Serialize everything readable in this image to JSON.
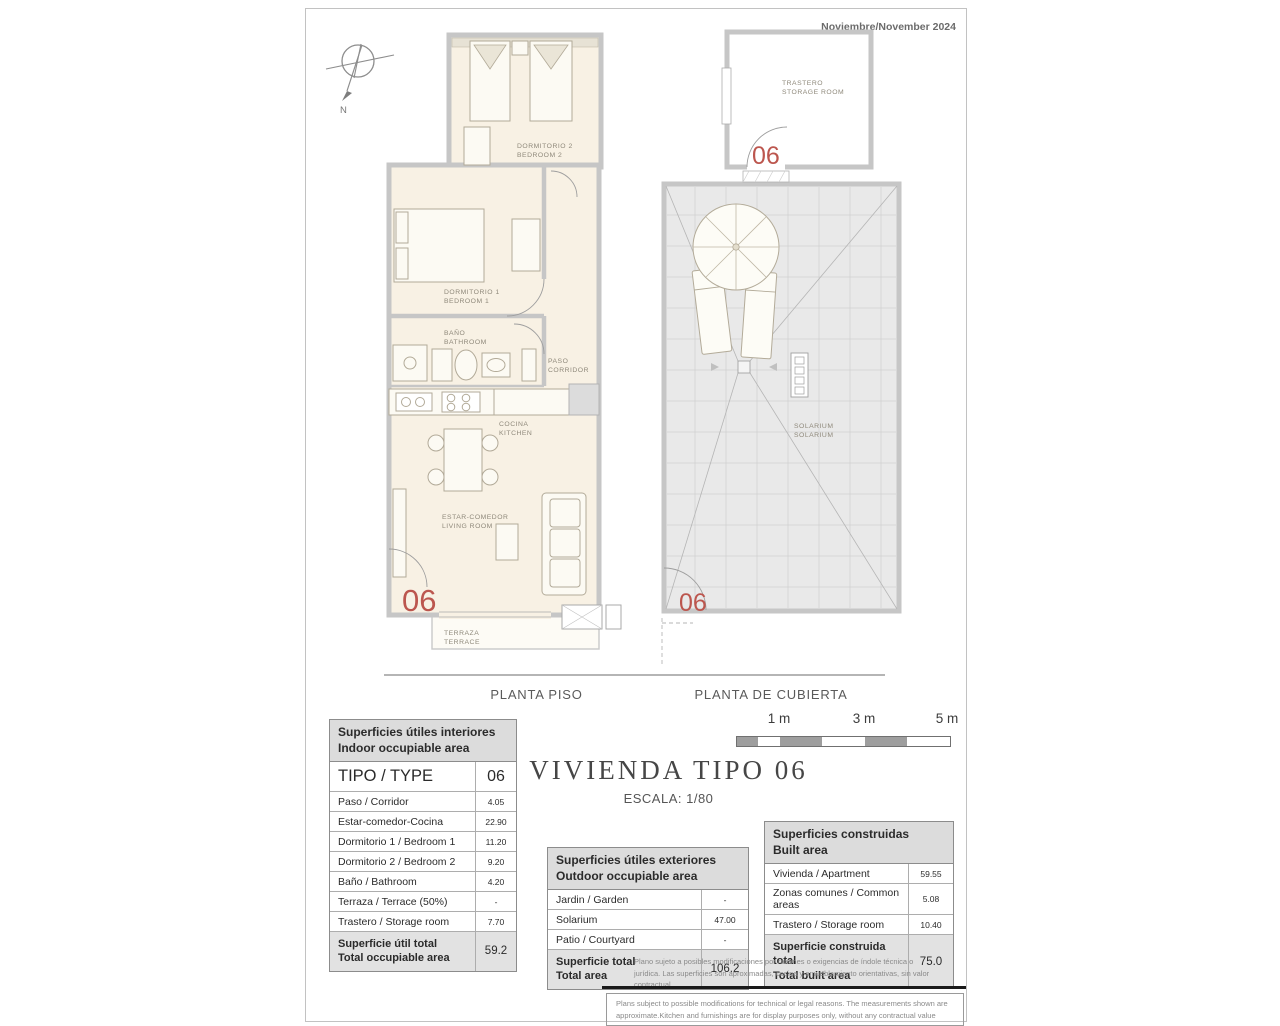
{
  "page": {
    "date": "Noviembre/November 2024",
    "title": "VIVIENDA TIPO 06",
    "scale": "ESCALA: 1/80",
    "unit": "06",
    "compass_n": "N",
    "captions": {
      "left": "PLANTA PISO",
      "right": "PLANTA DE CUBIERTA"
    },
    "scalebar": {
      "m1": "1 m",
      "m3": "3 m",
      "m5": "5 m"
    }
  },
  "rooms": {
    "bedroom2": [
      "DORMITORIO 2",
      "BEDROOM 2"
    ],
    "bedroom1": [
      "DORMITORIO 1",
      "BEDROOM 1"
    ],
    "bath": [
      "BAÑO",
      "BATHROOM"
    ],
    "corridor": [
      "PASO",
      "CORRIDOR"
    ],
    "kitchen": [
      "COCINA",
      "KITCHEN"
    ],
    "living": [
      "ESTAR-COMEDOR",
      "LIVING ROOM"
    ],
    "terrace": [
      "TERRAZA",
      "TERRACE"
    ],
    "storage": [
      "TRASTERO",
      "STORAGE ROOM"
    ],
    "solarium": [
      "SOLARIUM",
      "SOLARIUM"
    ]
  },
  "tables": {
    "interior": {
      "title": [
        "Superficies útiles interiores",
        "Indoor occupiable area"
      ],
      "type_row": {
        "label": "TIPO / TYPE",
        "value": "06"
      },
      "rows": [
        {
          "label": "Paso / Corridor",
          "value": "4.05"
        },
        {
          "label": "Estar-comedor-Cocina",
          "value": "22.90"
        },
        {
          "label": "Dormitorio 1 / Bedroom 1",
          "value": "11.20"
        },
        {
          "label": "Dormitorio 2 / Bedroom 2",
          "value": "9.20"
        },
        {
          "label": "Baño / Bathroom",
          "value": "4.20"
        },
        {
          "label": "Terraza / Terrace (50%)",
          "value": "-"
        },
        {
          "label": "Trastero / Storage room",
          "value": "7.70"
        }
      ],
      "total": {
        "label": [
          "Superficie útil total",
          "Total occupiable area"
        ],
        "value": "59.2"
      }
    },
    "exterior": {
      "title": [
        "Superficies útiles exteriores",
        "Outdoor occupiable area"
      ],
      "rows": [
        {
          "label": "Jardin / Garden",
          "value": "-"
        },
        {
          "label": "Solarium",
          "value": "47.00"
        },
        {
          "label": "Patio / Courtyard",
          "value": "-"
        }
      ],
      "total": {
        "label": [
          "Superficie total",
          "Total area"
        ],
        "value": "106.2"
      }
    },
    "built": {
      "title": [
        "Superficies construidas",
        "Built area"
      ],
      "rows": [
        {
          "label": "Vivienda / Apartment",
          "value": "59.55"
        },
        {
          "label": "Zonas comunes / Common areas",
          "value": "5.08"
        },
        {
          "label": "Trastero / Storage room",
          "value": "10.40"
        }
      ],
      "total": {
        "label": [
          "Superficie construida total",
          "Total built area"
        ],
        "value": "75.0"
      }
    }
  },
  "disclaimer": {
    "es": "Plano sujeto a posibles modificaciones por razones o exigencias de índole técnica o jurídica. Las superficies son aproximadas, cocina y amueblamiento  orientativas, sin valor contractual",
    "en": "Plans subject to possible modifications for technical or legal reasons. The measurements shown are approximate.Kitchen and furnishings are for display purposes only, without any contractual value"
  }
}
